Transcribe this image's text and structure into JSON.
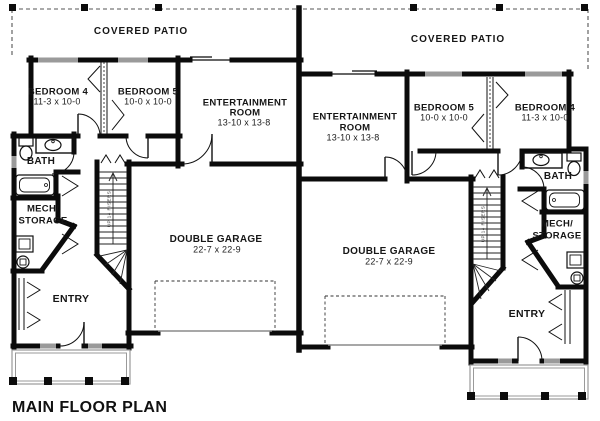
{
  "plan": {
    "title": "MAIN FLOOR PLAN",
    "colors": {
      "wall": "#0b0b0b",
      "window": "#9a9a9a",
      "porch": "#9a9a9a",
      "paper": "#ffffff"
    },
    "units": {
      "left": {
        "covered_patio": "COVERED PATIO",
        "bedroom4_name": "BEDROOM 4",
        "bedroom4_dims": "11-3 x 10-0",
        "bedroom5_name": "BEDROOM 5",
        "bedroom5_dims": "10-0 x 10-0",
        "entertainment_name1": "ENTERTAINMENT",
        "entertainment_name2": "ROOM",
        "entertainment_dims": "13-10 x 13-8",
        "bath": "BATH",
        "mech1": "MECH/",
        "mech2": "STORAGE",
        "entry": "ENTRY",
        "garage_name": "DOUBLE GARAGE",
        "garage_dims": "22-7 x 22-9",
        "stairs": "UP 14 RISERS"
      },
      "right": {
        "covered_patio": "COVERED PATIO",
        "bedroom4_name": "BEDROOM 4",
        "bedroom4_dims": "11-3 x 10-0",
        "bedroom5_name": "BEDROOM 5",
        "bedroom5_dims": "10-0 x 10-0",
        "entertainment_name1": "ENTERTAINMENT",
        "entertainment_name2": "ROOM",
        "entertainment_dims": "13-10 x 13-8",
        "bath": "BATH",
        "mech1": "MECH/",
        "mech2": "STORAGE",
        "entry": "ENTRY",
        "garage_name": "DOUBLE GARAGE",
        "garage_dims": "22-7 x 22-9",
        "stairs": "UP 14 RISERS"
      }
    }
  }
}
